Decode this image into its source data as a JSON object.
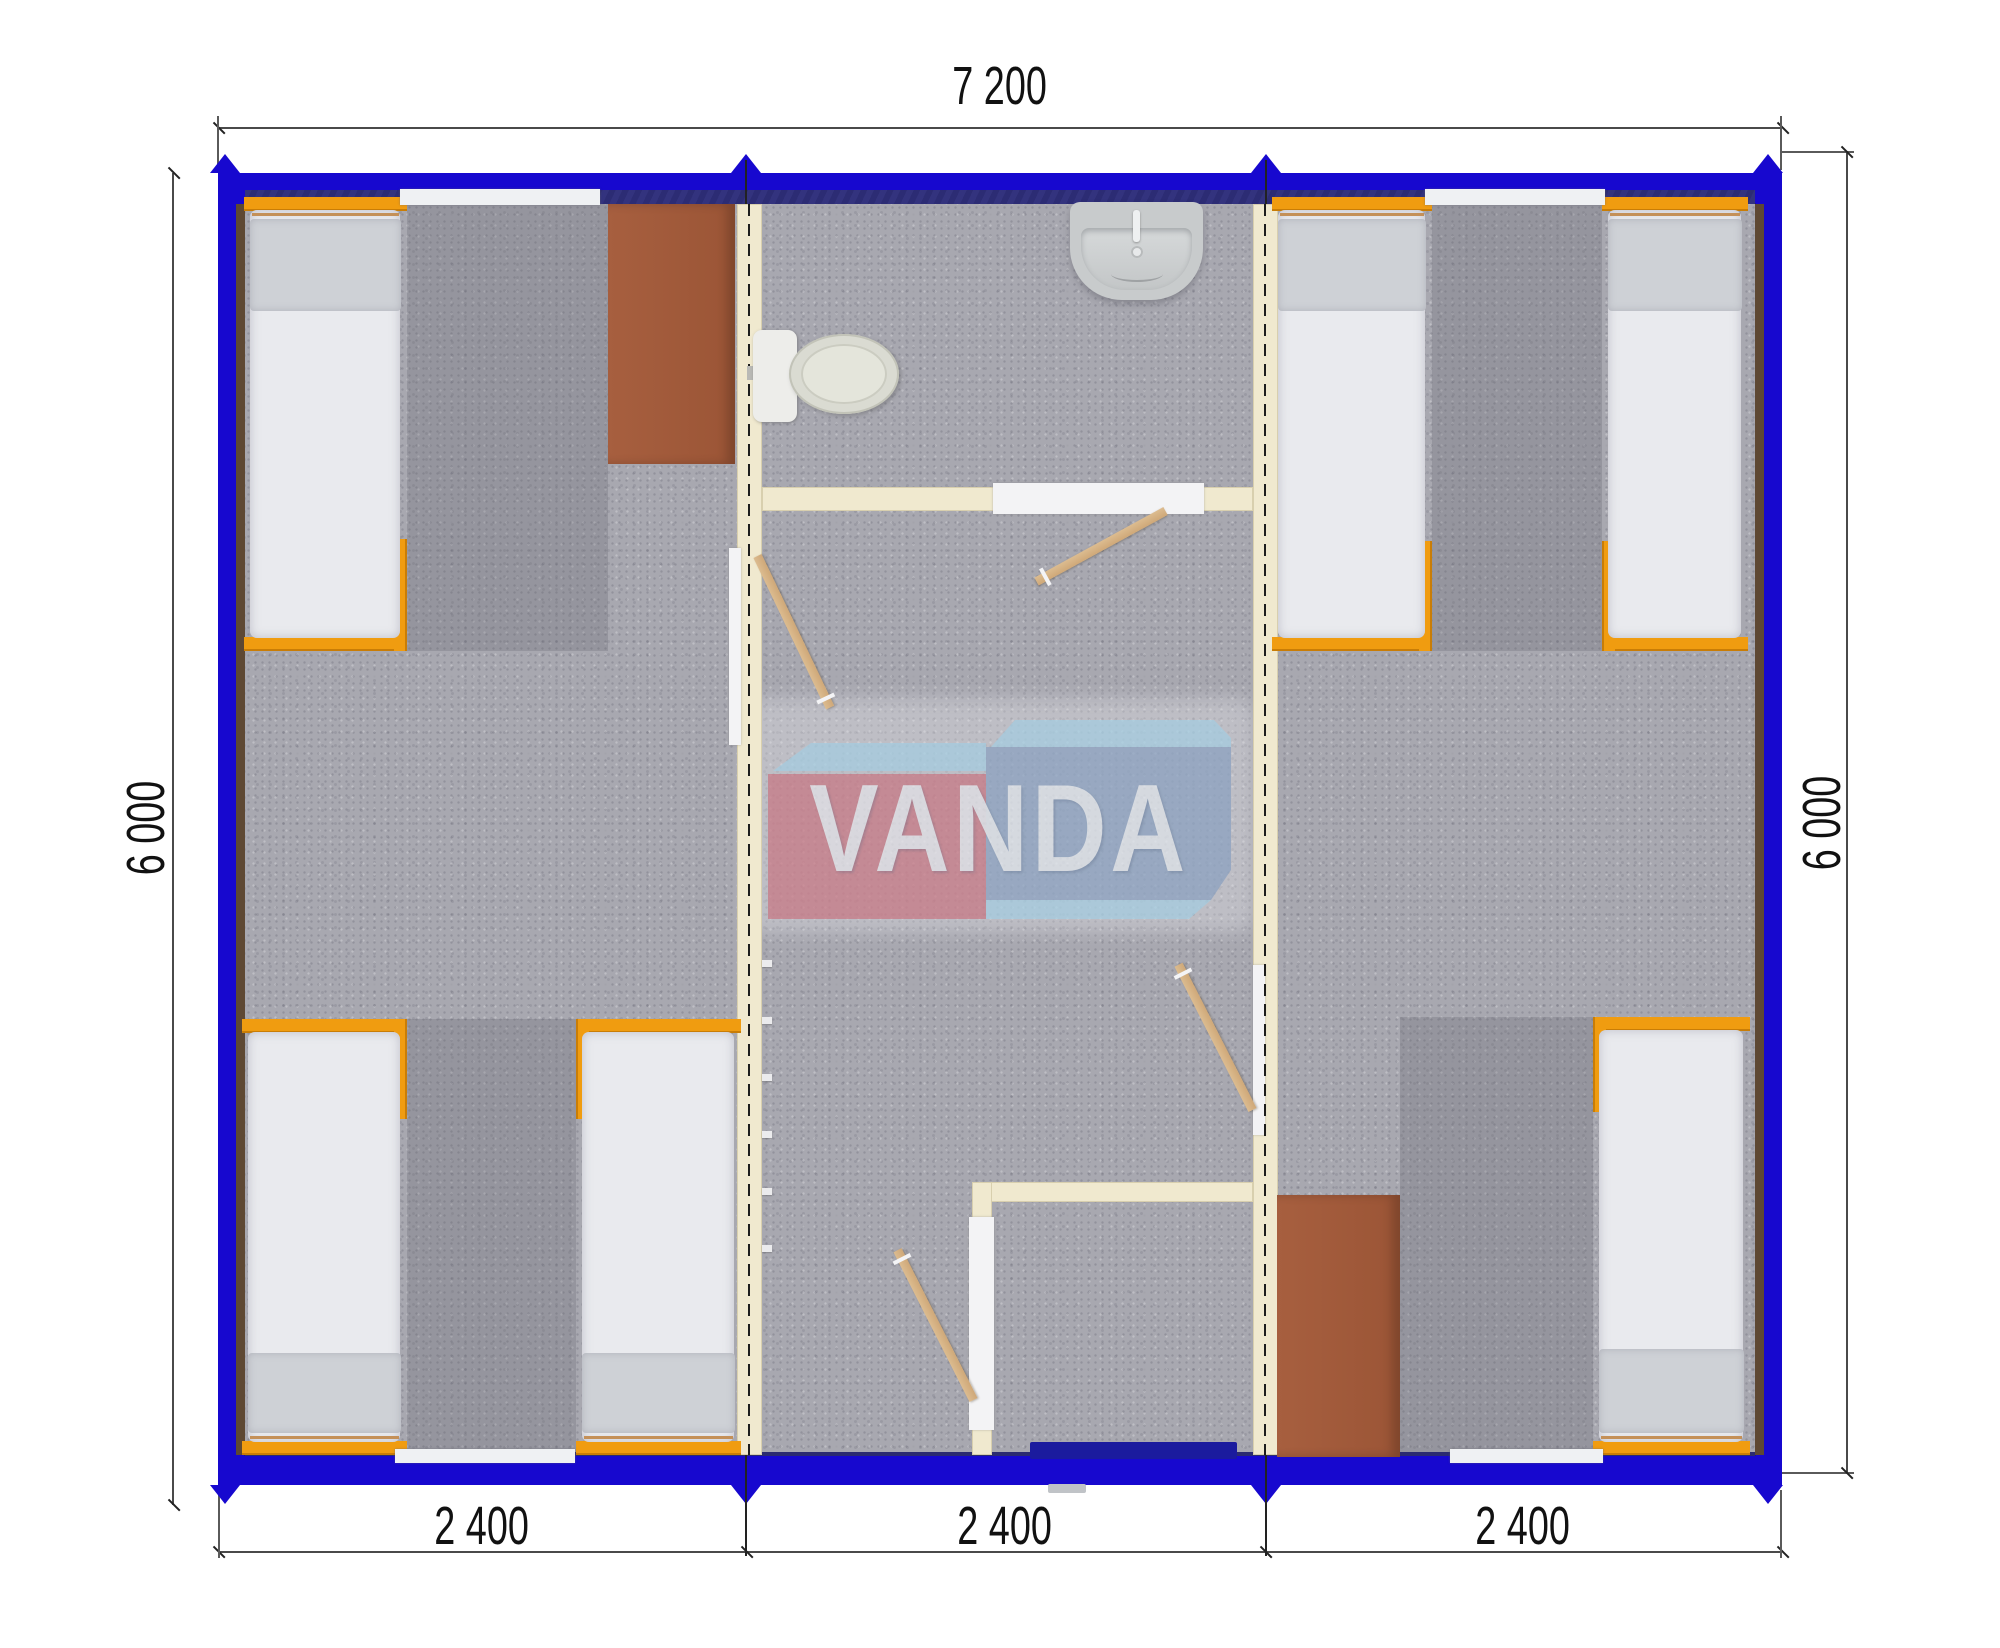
{
  "dimensions": {
    "top": "7 200",
    "left": "6 000",
    "right": "6 000",
    "bottom": [
      "2 400",
      "2 400",
      "2 400"
    ]
  },
  "watermark": {
    "text": "VANDA"
  },
  "plan": {
    "modules": 3,
    "bed_count": 6,
    "wardrobe_count": 2,
    "interior_door_count": 4
  },
  "colors": {
    "wall_blue": "#1708cf",
    "wall_inner_navy": "#2f2f7a",
    "partition_cream": "#f0e9cf",
    "bed_frame_orange": "#f09c10",
    "wardrobe_brown": "#a15a3b",
    "floor_gray": "#a8a8b0",
    "door_tan": "#d7b488",
    "entry_door_navy": "#1b1b9e",
    "logo_red": "#d4808d",
    "logo_blue": "#92a9c9",
    "logo_lightblue": "#a9d3e8"
  }
}
